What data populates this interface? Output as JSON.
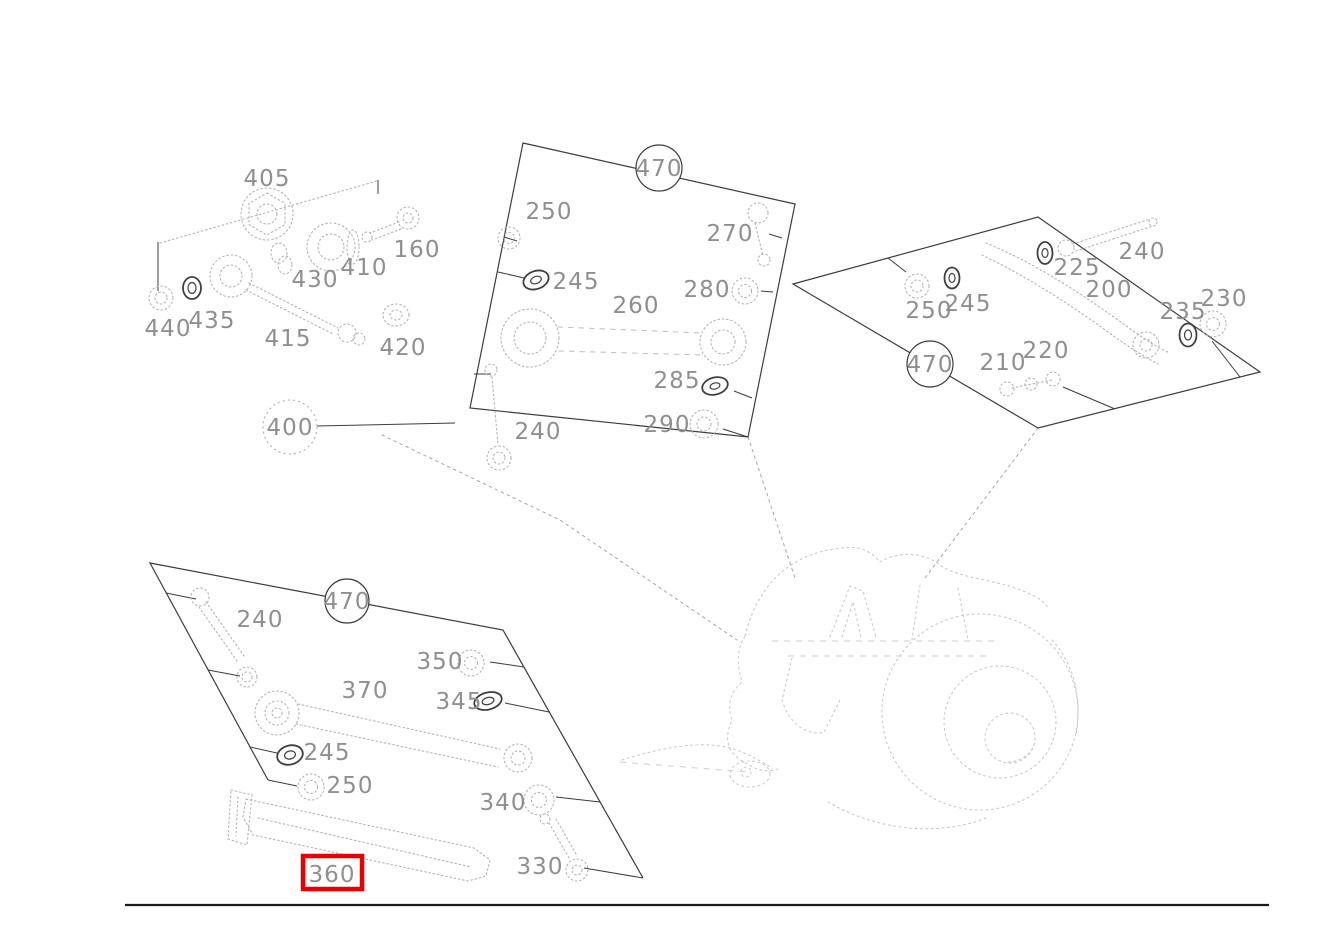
{
  "labels": {
    "top_left": [
      "405",
      "160",
      "410",
      "430",
      "435",
      "440",
      "415",
      "420"
    ],
    "middle": {
      "group": "470",
      "items": [
        "250",
        "245",
        "260",
        "270",
        "280",
        "285",
        "290",
        "240"
      ]
    },
    "right": {
      "group": "470",
      "items": [
        "250",
        "245",
        "225",
        "240",
        "200",
        "230",
        "235",
        "210",
        "220"
      ]
    },
    "bottom": {
      "group": "470",
      "items": [
        "240",
        "350",
        "370",
        "345",
        "245",
        "250",
        "340",
        "330",
        "360"
      ]
    },
    "assembly_ref": "400"
  },
  "highlight": {
    "part": "360",
    "color": "#e60000"
  }
}
